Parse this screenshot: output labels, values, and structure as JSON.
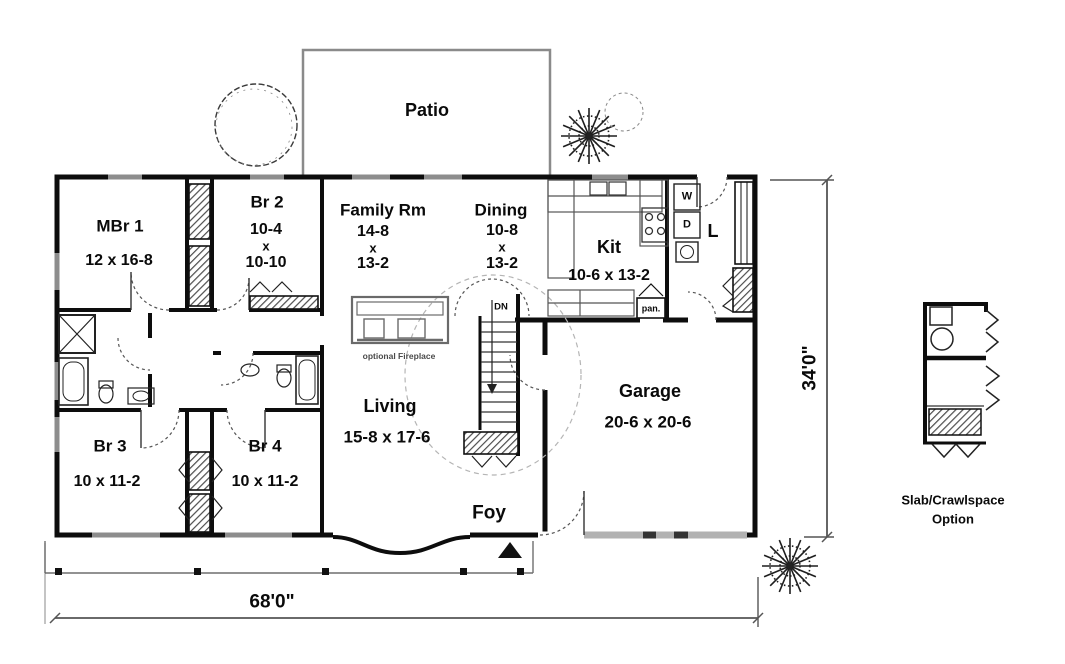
{
  "plan_title": "Ranch house first floor plan",
  "patio": {
    "label": "Patio"
  },
  "rooms": {
    "mbr1": {
      "name": "MBr 1",
      "dims": [
        "12 x 16-8"
      ]
    },
    "br2": {
      "name": "Br 2",
      "dims": [
        "10-4",
        "x",
        "10-10"
      ]
    },
    "family": {
      "name": "Family Rm",
      "dims": [
        "14-8",
        "x",
        "13-2"
      ]
    },
    "dining": {
      "name": "Dining",
      "dims": [
        "10-8",
        "x",
        "13-2"
      ]
    },
    "kit": {
      "name": "Kit",
      "dims": [
        "10-6 x 13-2"
      ]
    },
    "laundry": {
      "name": "L"
    },
    "garage": {
      "name": "Garage",
      "dims": [
        "20-6 x 20-6"
      ]
    },
    "living": {
      "name": "Living",
      "dims": [
        "15-8 x 17-6"
      ]
    },
    "br3": {
      "name": "Br 3",
      "dims": [
        "10 x 11-2"
      ]
    },
    "br4": {
      "name": "Br 4",
      "dims": [
        "10 x 11-2"
      ]
    },
    "foyer": {
      "name": "Foy"
    }
  },
  "annotations": {
    "stairs_down": "DN",
    "washer": "W",
    "dryer": "D",
    "pantry": "pan.",
    "optional_fireplace": "optional Fireplace"
  },
  "dimensions": {
    "overall_width": "68'0\"",
    "overall_depth": "34'0\""
  },
  "option_detail": {
    "line1": "Slab/Crawlspace",
    "line2": "Option"
  },
  "colors": {
    "wall": "#0d0d0d",
    "window": "#8d8d8d",
    "dimension_line": "#555555",
    "background": "#ffffff"
  }
}
